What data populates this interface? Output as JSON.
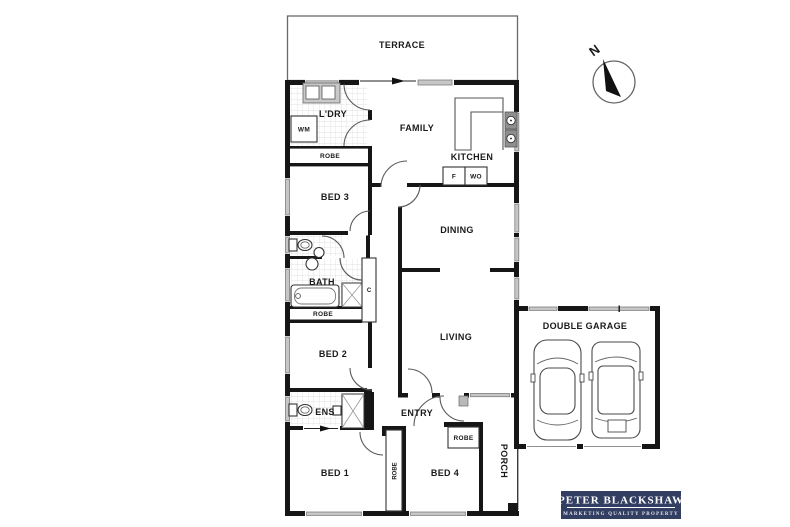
{
  "plan": {
    "rooms": {
      "terrace": "TERRACE",
      "laundry": "L'DRY",
      "family": "FAMILY",
      "kitchen": "KITCHEN",
      "bed3": "BED 3",
      "dining": "DINING",
      "bath": "BATH",
      "bed2": "BED 2",
      "living": "LIVING",
      "garage": "DOUBLE GARAGE",
      "ens": "ENS",
      "entry": "ENTRY",
      "bed1": "BED 1",
      "bed4": "BED 4",
      "porch": "PORCH"
    },
    "fixtures": {
      "wm": "WM",
      "robe_laundry": "ROBE",
      "robe_bath": "ROBE",
      "robe_bed1": "ROBE",
      "robe_bed4": "ROBE",
      "fridge": "F",
      "wall_oven": "WO",
      "cupboard": "C"
    },
    "compass": {
      "north": "N"
    }
  },
  "branding": {
    "agency": "PETER BLACKSHAW",
    "tagline": "MARKETING QUALITY PROPERTY",
    "bg_color": "#333e63",
    "text_color": "#ffffff"
  },
  "colors": {
    "wall": "#161616",
    "window": "#c6c6c6",
    "tile_line": "#d8d8d8",
    "background": "#ffffff"
  }
}
